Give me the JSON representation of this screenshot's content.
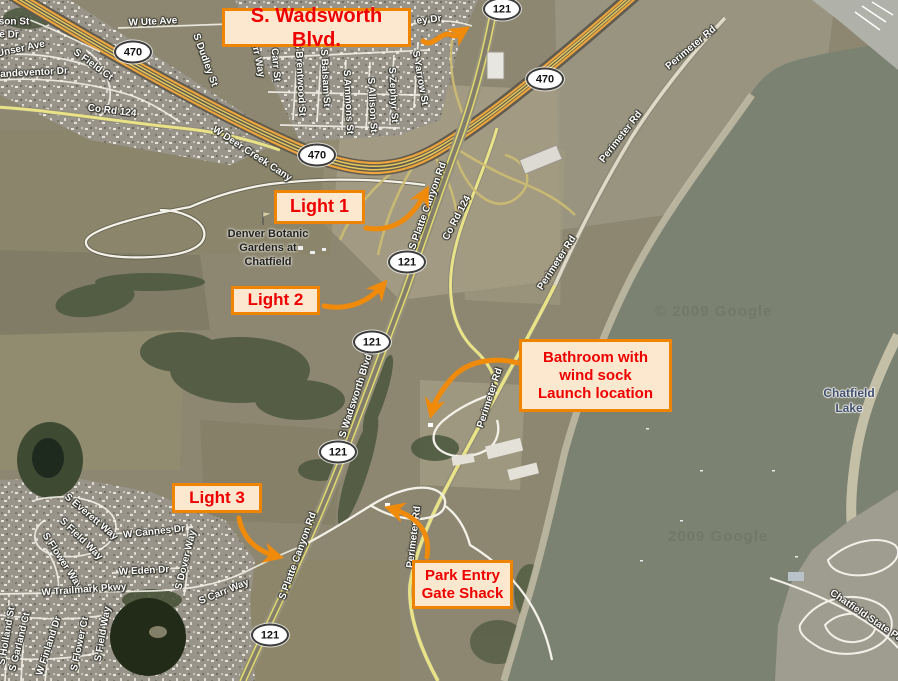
{
  "callouts": {
    "wadsworth": "S. Wadsworth Blvd.",
    "light1": "Light 1",
    "light2": "Light 2",
    "bathroom_l1": "Bathroom with",
    "bathroom_l2": "wind sock",
    "bathroom_l3": "Launch location",
    "light3": "Light 3",
    "gate_l1": "Park Entry",
    "gate_l2": "Gate Shack"
  },
  "shields": {
    "c470": "470",
    "sh121": "121"
  },
  "places": {
    "gardens_l1": "Denver Botanic",
    "gardens_l2": "Gardens at",
    "gardens_l3": "Chatfield",
    "lake_l1": "Chatfield",
    "lake_l2": "Lake"
  },
  "watermarks": {
    "w1": "© 2009 Google",
    "w2": "2009 Google"
  },
  "streets": [
    {
      "name": "son St"
    },
    {
      "name": "e Dr"
    },
    {
      "name": "Unser Ave"
    },
    {
      "name": "Vandeventor Dr"
    },
    {
      "name": "S Field Ct"
    },
    {
      "name": "W Ute Ave"
    },
    {
      "name": "S Dudley St"
    },
    {
      "name": "Carr Way"
    },
    {
      "name": "S Carr St"
    },
    {
      "name": "S Brentwood St"
    },
    {
      "name": "S Balsam St"
    },
    {
      "name": "S Ammons St"
    },
    {
      "name": "S Allison St"
    },
    {
      "name": "S Zephyr St"
    },
    {
      "name": "S Yarrow St"
    },
    {
      "name": "ey Dr"
    },
    {
      "name": "Co Rd 124"
    },
    {
      "name": "W Deer Creek Cany"
    },
    {
      "name": "S Platte Canyon Rd"
    },
    {
      "name": "Co Rd 124"
    },
    {
      "name": "Perimeter Rd"
    },
    {
      "name": "Perimeter Rd"
    },
    {
      "name": "Perimeter Rd"
    },
    {
      "name": "Perimeter Rd"
    },
    {
      "name": "Perimeter Rd"
    },
    {
      "name": "S Wadsworth Blvd"
    },
    {
      "name": "S Platte Canyon Rd"
    },
    {
      "name": "S Everett Way"
    },
    {
      "name": "S Field Way"
    },
    {
      "name": "S Flower Way"
    },
    {
      "name": "W Cannes Dr"
    },
    {
      "name": "W Eden Dr"
    },
    {
      "name": "S Dover Way"
    },
    {
      "name": "W Trailmark Pkwy"
    },
    {
      "name": "S Holland St"
    },
    {
      "name": "S Garland Ct"
    },
    {
      "name": "W Finland Dr"
    },
    {
      "name": "S Flower Ct"
    },
    {
      "name": "S Field Way"
    },
    {
      "name": "S Carr Way"
    },
    {
      "name": "Chatfield State Pa"
    }
  ],
  "colors": {
    "callout_bg": "#fce8cf",
    "callout_border": "#ef8400",
    "callout_text": "#ee0000",
    "arrow": "#ef8a0a",
    "lake": "#7c8272",
    "terrain": "#8d8771"
  }
}
